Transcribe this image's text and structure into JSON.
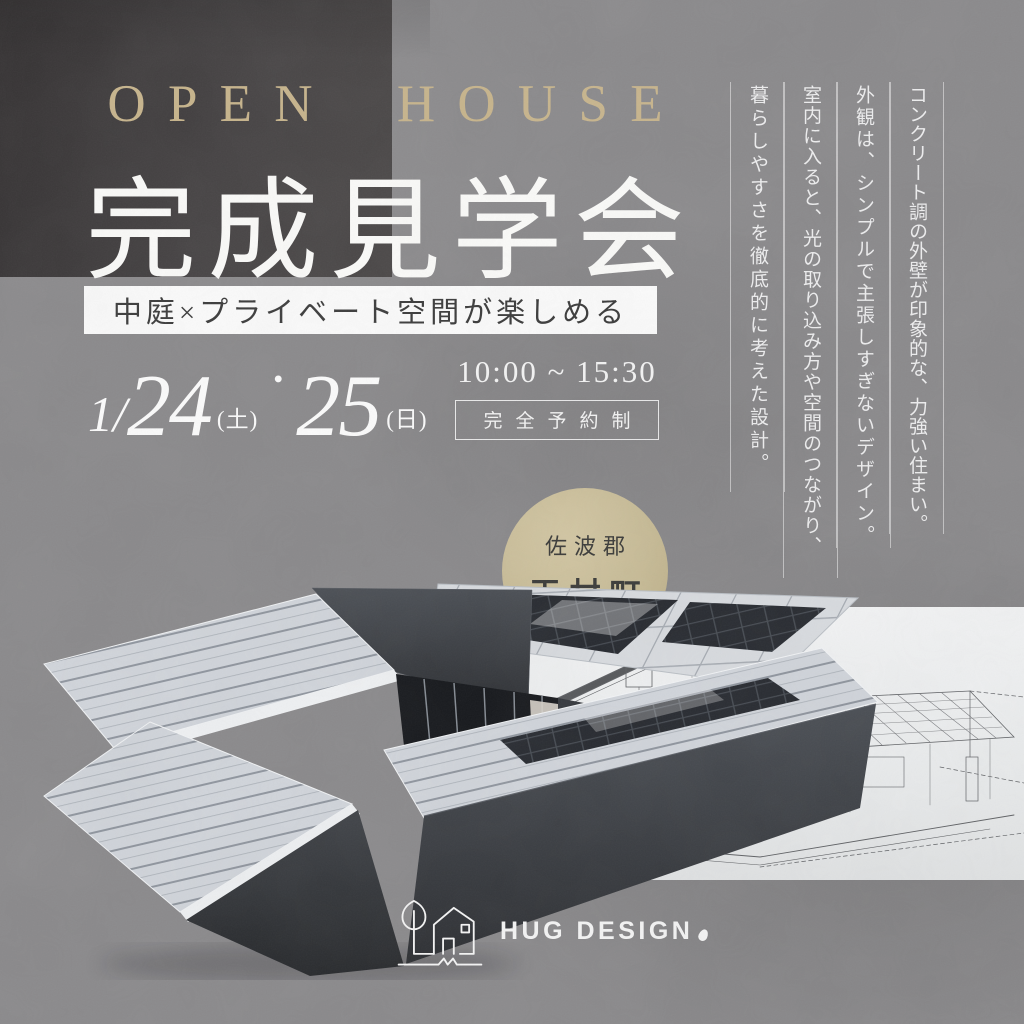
{
  "poster": {
    "eyebrow": "OPEN HOUSE",
    "title": "完成見学会",
    "tagline": "中庭×プライベート空間が楽しめる",
    "schedule": {
      "date_prefix": "1/",
      "day1": "24",
      "day1_suffix": "(土)",
      "separator": "・",
      "day2": "25",
      "day2_suffix": "(日)",
      "time": "10:00 ~ 15:30",
      "reservation_note": "完全予約制"
    },
    "location": {
      "district": "佐波郡",
      "town": "玉村町"
    },
    "vertical_copy": [
      "コンクリート調の外壁が印象的な、力強い住まい。",
      "外観は、シンプルで主張しすぎないデザイン。",
      "室内に入ると、光の取り込み方や空間のつながり、",
      "暮らしやすさを徹底的に考えた設計。"
    ],
    "brand": {
      "name": "HUG DESIGN"
    },
    "images": {
      "left": "exterior-3d-render-courtyard-house",
      "right": "architectural-wireframe-drawing"
    },
    "colors": {
      "background": "#8a898b",
      "accent_gold": "#c7b48c",
      "circle_gold": "#c9bd99",
      "text_light": "#f5f5f5",
      "text_dark": "#3b3b3b",
      "dark_block": "#454243",
      "panel_white": "#eef0f1"
    }
  }
}
